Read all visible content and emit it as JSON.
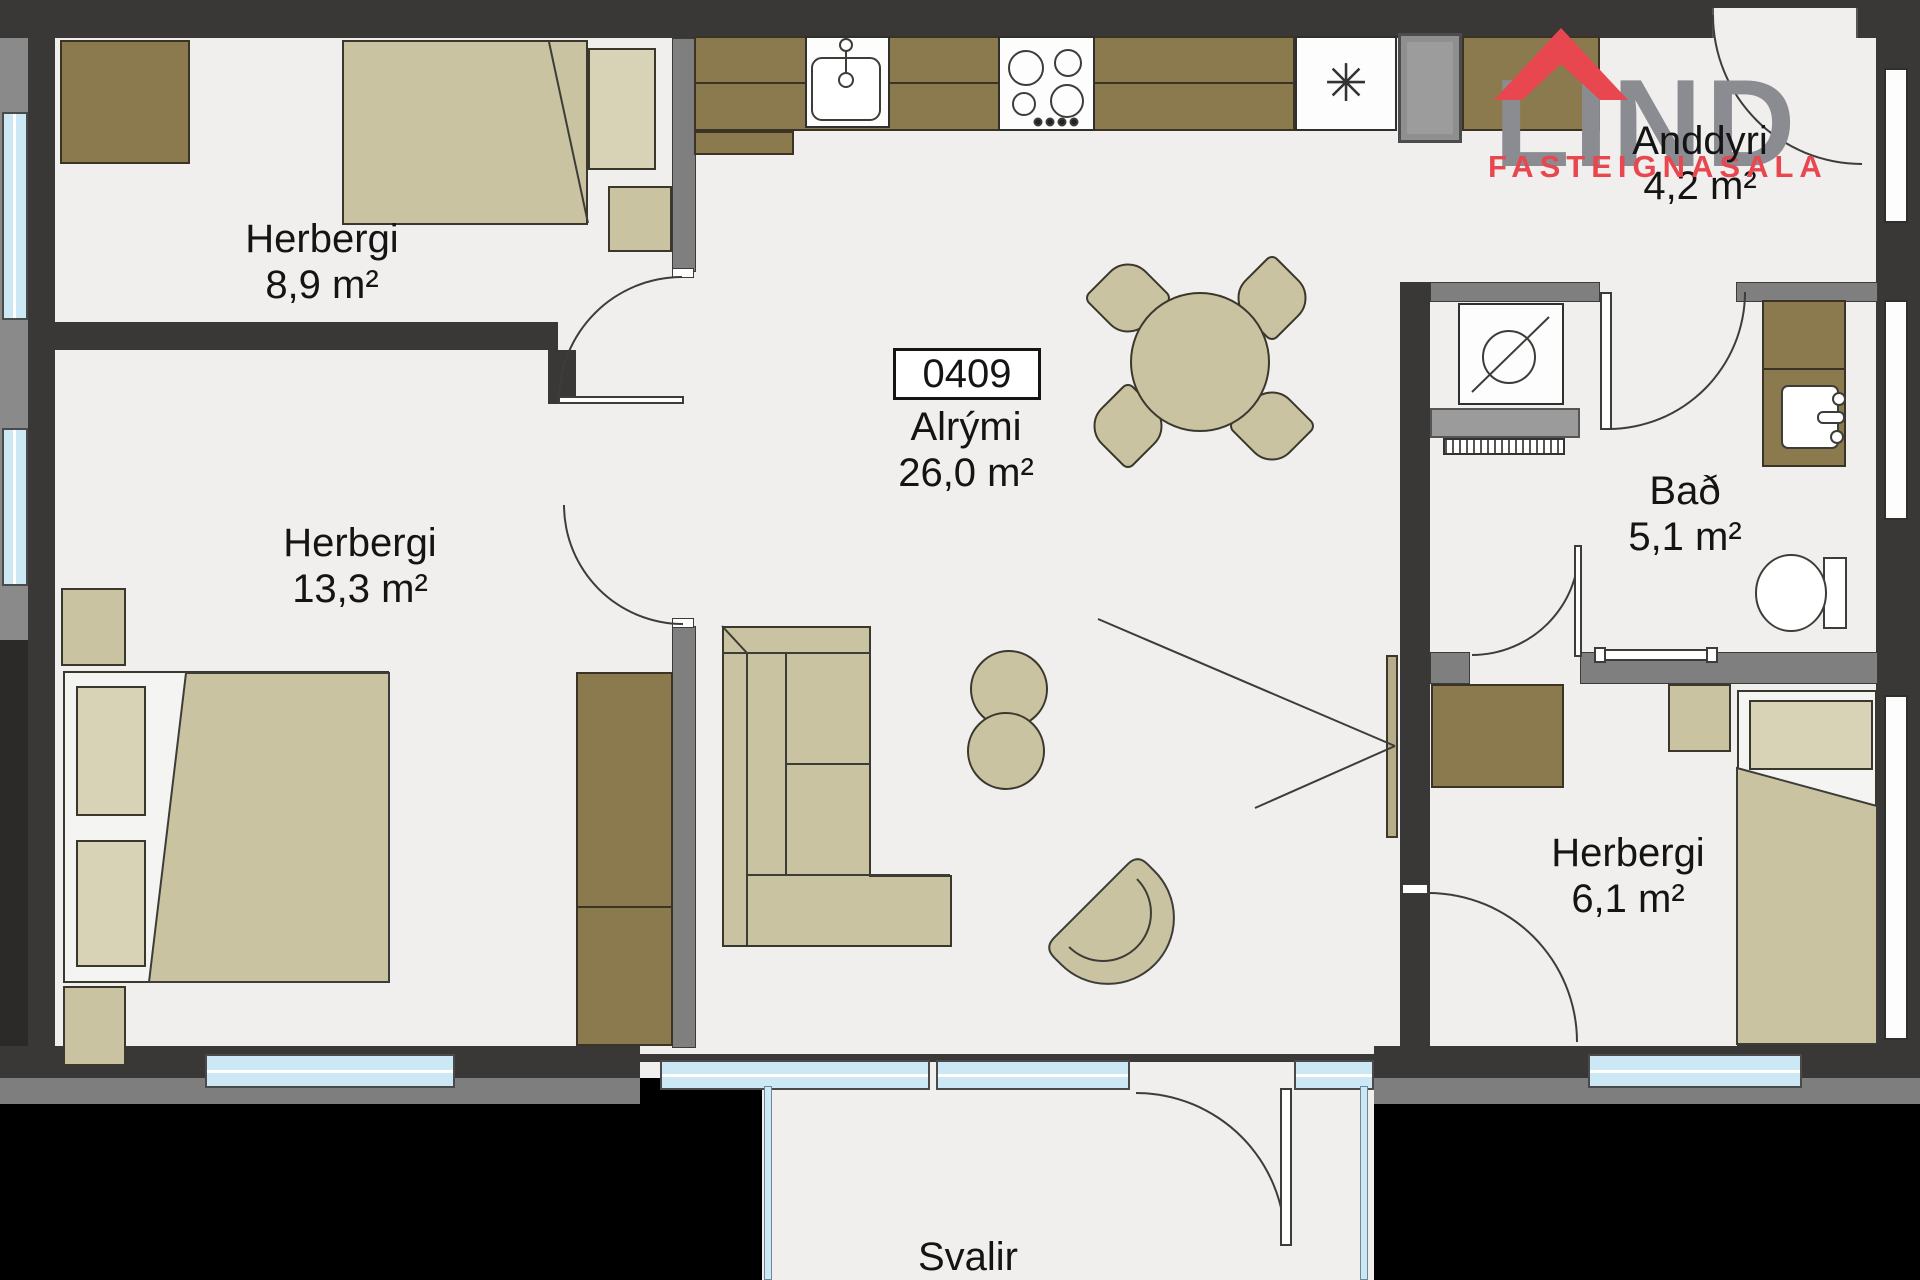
{
  "logo": {
    "word": "LIND",
    "subtitle": "FASTEIGNASALA"
  },
  "unit": {
    "number": "0409"
  },
  "rooms": {
    "bedroom1": {
      "name": "Herbergi",
      "area": "8,9 m²"
    },
    "bedroom2": {
      "name": "Herbergi",
      "area": "13,3 m²"
    },
    "living": {
      "name": "Alrými",
      "area": "26,0 m²"
    },
    "entry": {
      "name": "Anddyri",
      "area": "4,2 m²"
    },
    "bath": {
      "name": "Bað",
      "area": "5,1 m²"
    },
    "bedroom3": {
      "name": "Herbergi",
      "area": "6,1 m²"
    },
    "balcony": {
      "name": "Svalir"
    }
  },
  "symbols": {
    "fridge_asterisk": "✳"
  },
  "colors": {
    "wall_dark": "#3a3836",
    "wall_gray": "#7f7f7f",
    "floor": "#f0efed",
    "cabinet_brown": "#8b7a4e",
    "furniture_khaki": "#cac3a1",
    "pillow": "#d8d2b6",
    "window_blue": "#cde8f5",
    "logo_gray": "#8b8c91",
    "logo_red": "#e8474f",
    "text": "#141414"
  }
}
